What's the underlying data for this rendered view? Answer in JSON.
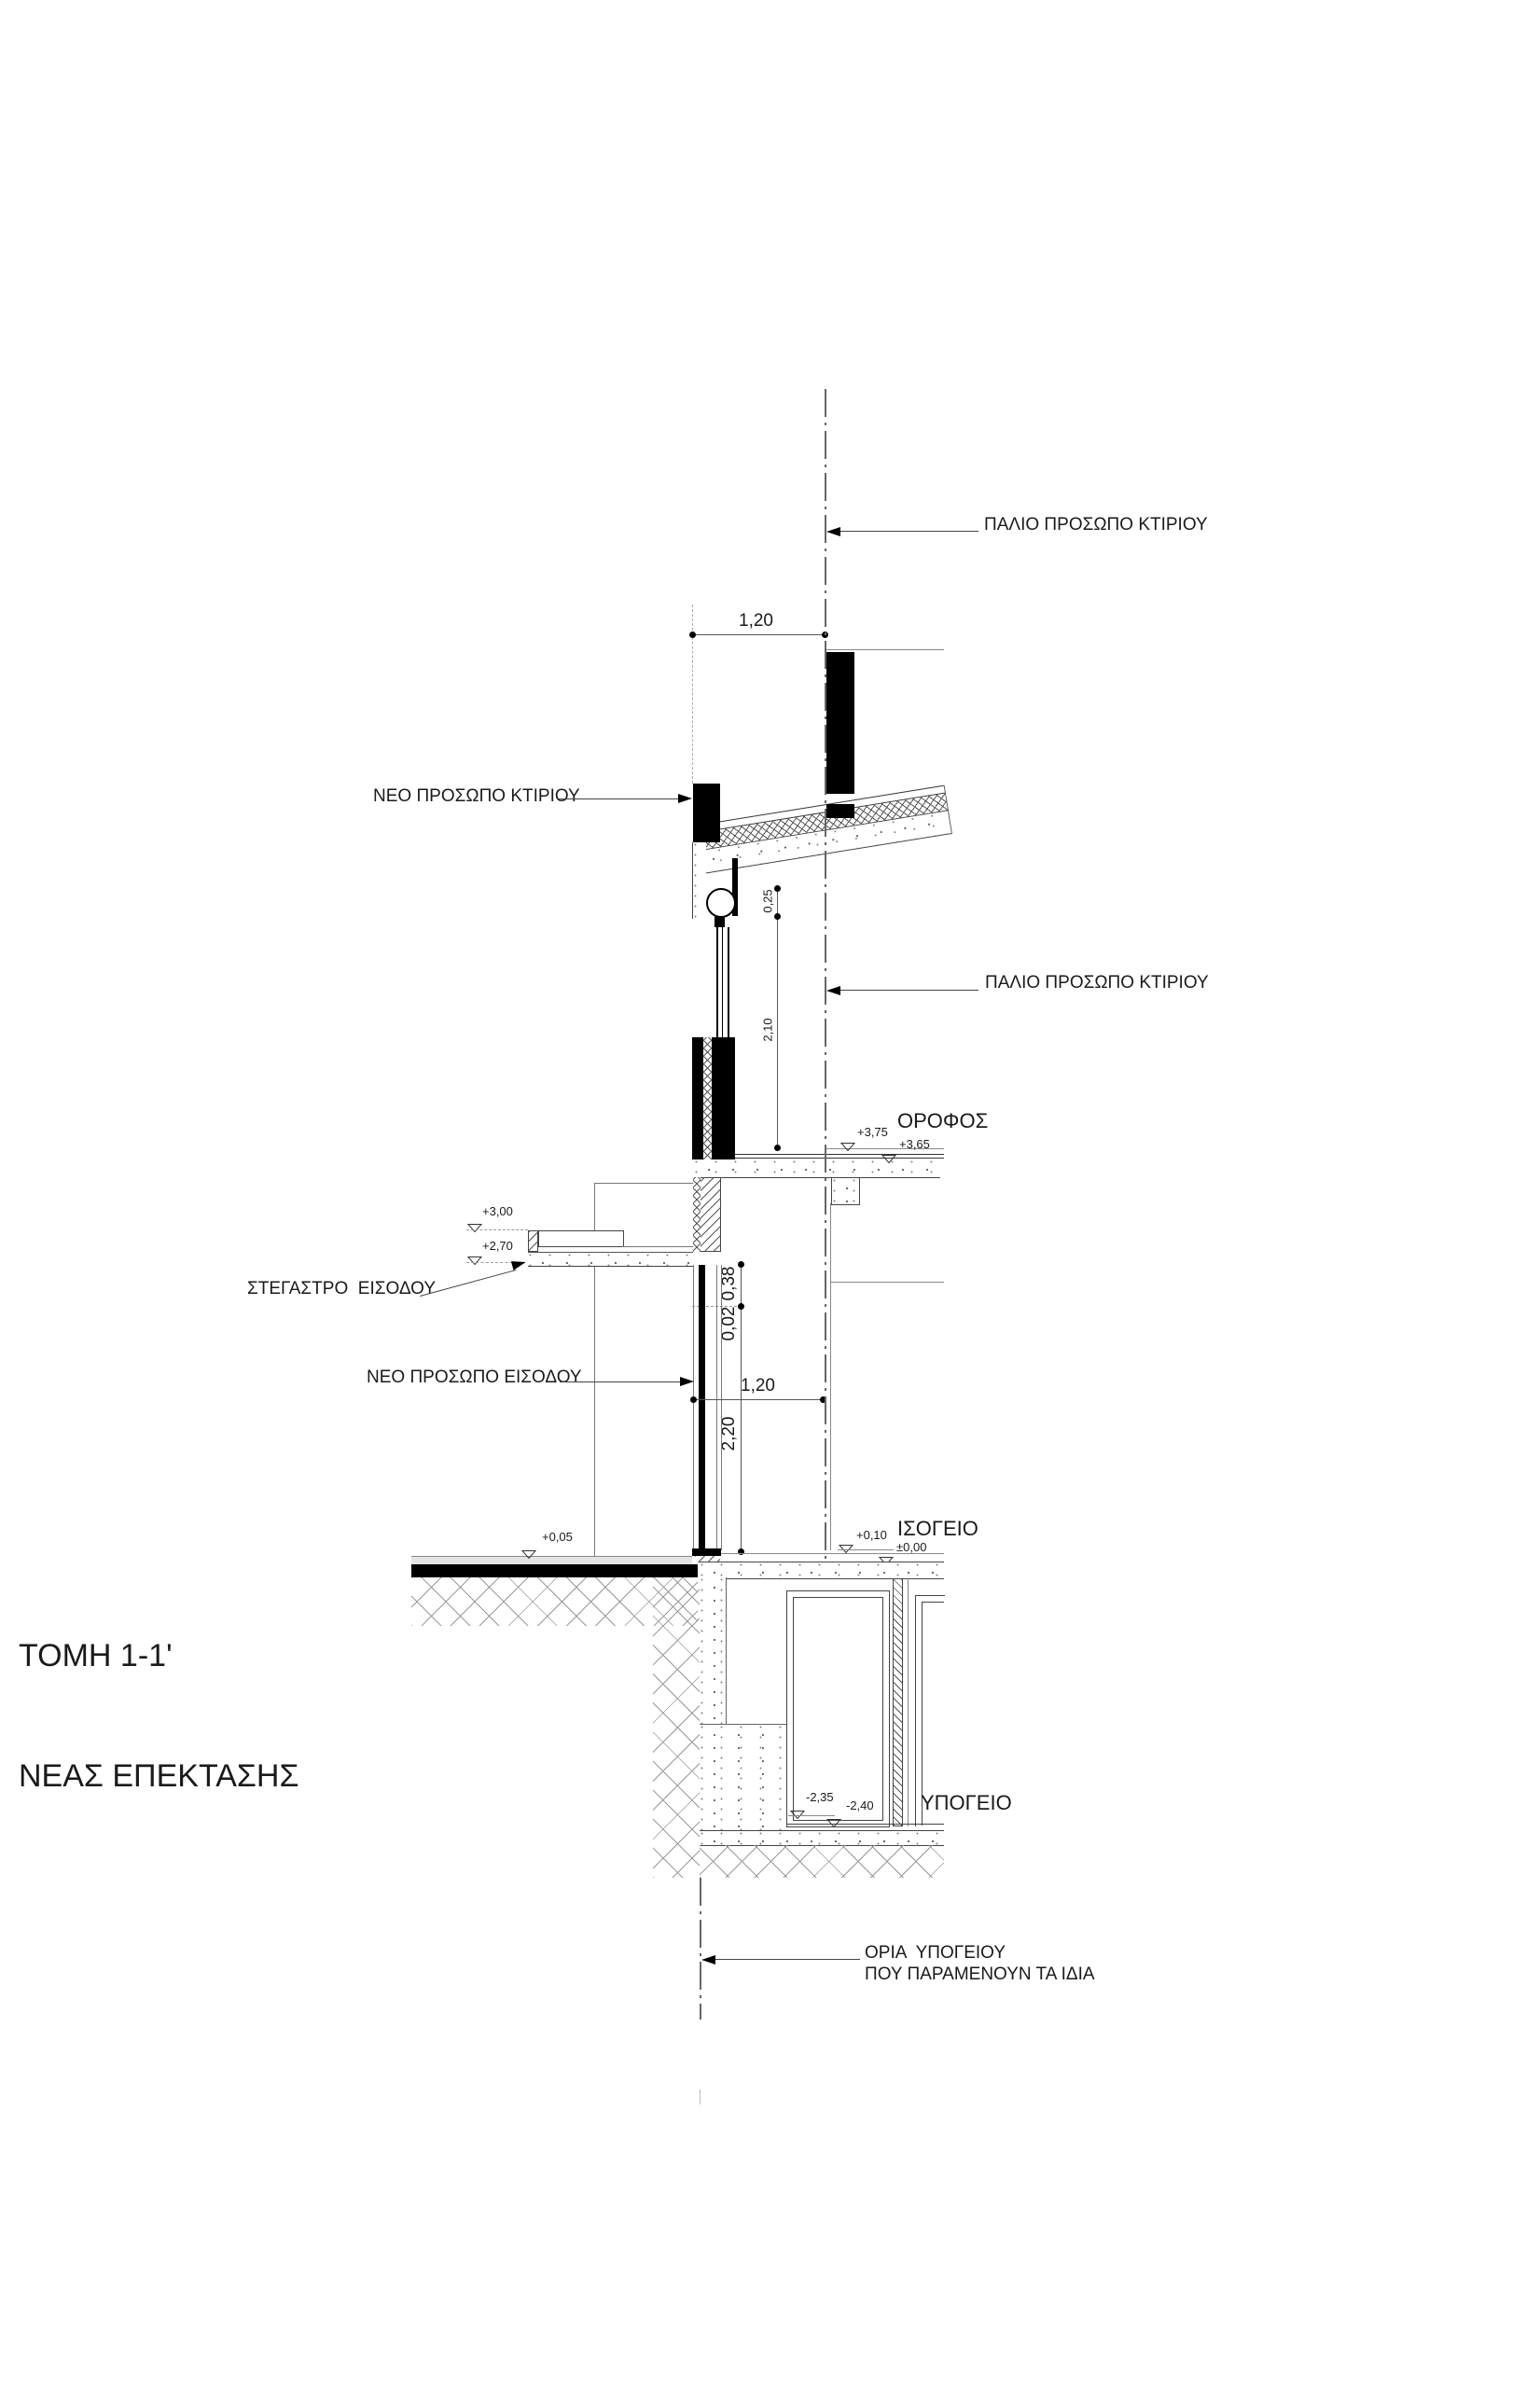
{
  "page": {
    "background": "#ffffff",
    "ink": "#1a1a1a"
  },
  "title": {
    "line1": "ΤΟΜΗ 1-1'",
    "line2": "ΝΕΑΣ ΕΠΕΚΤΑΣΗΣ"
  },
  "labels": {
    "old_face_top": "ΠΑΛΙΟ ΠΡΟΣΩΠΟ ΚΤΙΡΙΟΥ",
    "old_face_mid": "ΠΑΛΙΟ ΠΡΟΣΩΠΟ ΚΤΙΡΙΟΥ",
    "new_face_building": "ΝΕΟ ΠΡΟΣΩΠΟ ΚΤΙΡΙΟΥ",
    "entrance_canopy": "ΣΤΕΓΑΣΤΡΟ  ΕΙΣΟΔΟΥ",
    "new_face_entrance": "ΝΕΟ ΠΡΟΣΩΠΟ ΕΙΣΟΔΟΥ",
    "basement_limits_line1": "ΟΡΙΑ  ΥΠΟΓΕΙΟΥ",
    "basement_limits_line2": "ΠΟΥ ΠΑΡΑΜΕΝΟΥΝ ΤΑ ΙΔΙΑ"
  },
  "storeys": {
    "upper": "ΟΡΟΦΟΣ",
    "ground": "ΙΣΟΓΕΙΟ",
    "basement": "ΥΠΟΓΕΙΟ"
  },
  "levels": {
    "p375": "+3,75",
    "p365": "+3,65",
    "p300": "+3,00",
    "p270": "+2,70",
    "p010": "+0,10",
    "p005": "+0,05",
    "zero": "±0,00",
    "m235": "-2,35",
    "m240": "-2,40"
  },
  "dimensions": {
    "top_offset": "1,20",
    "roller": "0,25",
    "window": "2,10",
    "d038": "0,38",
    "d002": "0,02",
    "entr_offset": "1,20",
    "door": "2,20"
  }
}
